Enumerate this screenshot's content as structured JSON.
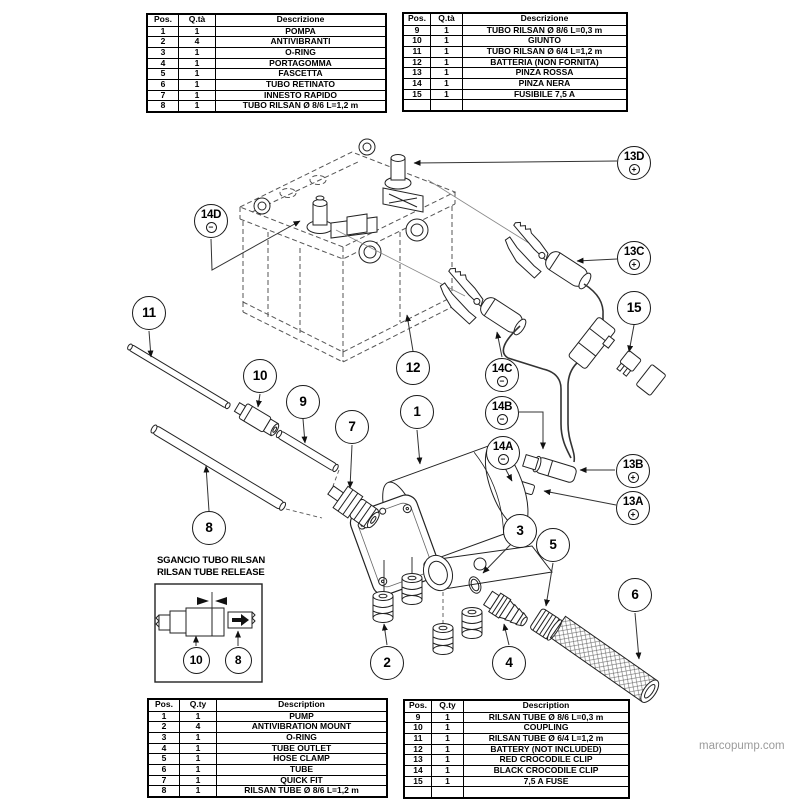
{
  "watermark": "marcopump.com",
  "inset": {
    "title_it": "SGANCIO TUBO RILSAN",
    "title_en": "RILSAN TUBE RELEASE"
  },
  "tables": {
    "top_left": {
      "headers": [
        "Pos.",
        "Q.tà",
        "Descrizione"
      ],
      "rows": [
        [
          "1",
          "1",
          "POMPA"
        ],
        [
          "2",
          "4",
          "ANTIVIBRANTI"
        ],
        [
          "3",
          "1",
          "O-RING"
        ],
        [
          "4",
          "1",
          "PORTAGOMMA"
        ],
        [
          "5",
          "1",
          "FASCETTA"
        ],
        [
          "6",
          "1",
          "TUBO RETINATO"
        ],
        [
          "7",
          "1",
          "INNESTO RAPIDO"
        ],
        [
          "8",
          "1",
          "TUBO RILSAN Ø 8/6 L=1,2 m"
        ]
      ]
    },
    "top_right": {
      "headers": [
        "Pos.",
        "Q.tà",
        "Descrizione"
      ],
      "rows": [
        [
          "9",
          "1",
          "TUBO RILSAN Ø 8/6 L=0,3 m"
        ],
        [
          "10",
          "1",
          "GIUNTO"
        ],
        [
          "11",
          "1",
          "TUBO RILSAN Ø 6/4 L=1,2 m"
        ],
        [
          "12",
          "1",
          "BATTERIA (NON FORNITA)"
        ],
        [
          "13",
          "1",
          "PINZA ROSSA"
        ],
        [
          "14",
          "1",
          "PINZA NERA"
        ],
        [
          "15",
          "1",
          "FUSIBILE 7,5 A"
        ],
        [
          "",
          "",
          ""
        ]
      ]
    },
    "bottom_left": {
      "headers": [
        "Pos.",
        "Q.ty",
        "Description"
      ],
      "rows": [
        [
          "1",
          "1",
          "PUMP"
        ],
        [
          "2",
          "4",
          "ANTIVIBRATION MOUNT"
        ],
        [
          "3",
          "1",
          "O-RING"
        ],
        [
          "4",
          "1",
          "TUBE OUTLET"
        ],
        [
          "5",
          "1",
          "HOSE CLAMP"
        ],
        [
          "6",
          "1",
          "TUBE"
        ],
        [
          "7",
          "1",
          "QUICK FIT"
        ],
        [
          "8",
          "1",
          "RILSAN TUBE Ø 8/6 L=1,2 m"
        ]
      ]
    },
    "bottom_right": {
      "headers": [
        "Pos.",
        "Q.ty",
        "Description"
      ],
      "rows": [
        [
          "9",
          "1",
          "RILSAN TUBE Ø 8/6 L=0,3 m"
        ],
        [
          "10",
          "1",
          "COUPLING"
        ],
        [
          "11",
          "1",
          "RILSAN TUBE Ø 6/4 L=1,2 m"
        ],
        [
          "12",
          "1",
          "BATTERY (NOT INCLUDED)"
        ],
        [
          "13",
          "1",
          "RED CROCODILE CLIP"
        ],
        [
          "14",
          "1",
          "BLACK CROCODILE CLIP"
        ],
        [
          "15",
          "1",
          "7,5 A FUSE"
        ],
        [
          "",
          "",
          ""
        ]
      ]
    }
  },
  "callouts": [
    {
      "label": "11",
      "x": 149,
      "y": 313
    },
    {
      "label": "14D",
      "x": 211,
      "y": 221,
      "symbol": "minus"
    },
    {
      "label": "10",
      "x": 260,
      "y": 376
    },
    {
      "label": "9",
      "x": 303,
      "y": 402
    },
    {
      "label": "7",
      "x": 352,
      "y": 427
    },
    {
      "label": "12",
      "x": 413,
      "y": 368
    },
    {
      "label": "1",
      "x": 417,
      "y": 412
    },
    {
      "label": "8",
      "x": 209,
      "y": 528
    },
    {
      "label": "13D",
      "x": 634,
      "y": 163,
      "symbol": "plus"
    },
    {
      "label": "13C",
      "x": 634,
      "y": 258,
      "symbol": "plus"
    },
    {
      "label": "15",
      "x": 634,
      "y": 308
    },
    {
      "label": "14C",
      "x": 502,
      "y": 375,
      "symbol": "minus"
    },
    {
      "label": "14B",
      "x": 502,
      "y": 413,
      "symbol": "minus"
    },
    {
      "label": "14A",
      "x": 503,
      "y": 453,
      "symbol": "minus"
    },
    {
      "label": "13B",
      "x": 633,
      "y": 471,
      "symbol": "plus"
    },
    {
      "label": "13A",
      "x": 633,
      "y": 508,
      "symbol": "plus"
    },
    {
      "label": "3",
      "x": 520,
      "y": 531
    },
    {
      "label": "5",
      "x": 553,
      "y": 545
    },
    {
      "label": "2",
      "x": 387,
      "y": 663
    },
    {
      "label": "4",
      "x": 509,
      "y": 663
    },
    {
      "label": "6",
      "x": 635,
      "y": 595
    },
    {
      "label": "10",
      "x": 196,
      "y": 660,
      "size": "small"
    },
    {
      "label": "8",
      "x": 238,
      "y": 660,
      "size": "small"
    }
  ]
}
